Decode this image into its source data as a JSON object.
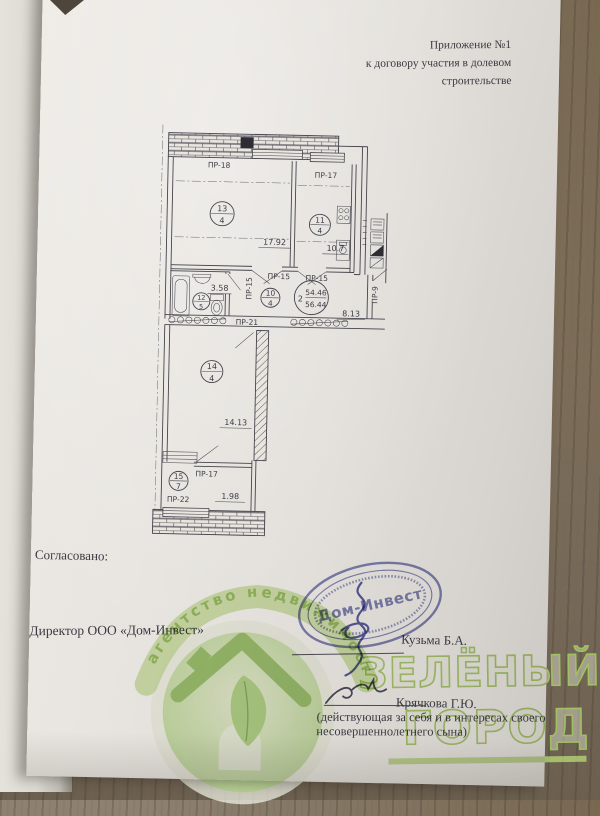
{
  "header": {
    "line1": "Приложение №1",
    "line2": "к договору участия в долевом строительстве"
  },
  "plan": {
    "window_labels": {
      "top_left": "ПР-18",
      "top_right": "ПР-17",
      "hall_left": "ПР-15",
      "hall_mid": "ПР-15",
      "hall_right": "ПР-15",
      "entry": "ПР-9",
      "partition": "ПР-21",
      "storage_door": "ПР-17",
      "storage_window": "ПР-22"
    },
    "rooms": {
      "living": {
        "num": "13",
        "type": "4",
        "area": "17.92"
      },
      "kitchen": {
        "num": "11",
        "type": "4",
        "area": "10.7"
      },
      "hall": {
        "num": "10",
        "type": "4"
      },
      "bath": {
        "num": "12",
        "type": "5",
        "area": "3.58"
      },
      "corridor": {
        "area": "8.13"
      },
      "room2": {
        "num": "14",
        "type": "4",
        "area": "14.13"
      },
      "storage": {
        "num": "15",
        "type": "7",
        "area": "1.98"
      }
    },
    "apartment": {
      "num": "2",
      "area_living": "54.46",
      "area_total": "56.44"
    }
  },
  "footer": {
    "agreed": "Согласовано:",
    "director": "Директор ООО «Дом-Инвест»",
    "director_name": "Кузьма Б.А.",
    "buyer_name": "Крячкова Г.Ю.",
    "buyer_note1": "(действующая за себя и в интересах своего",
    "buyer_note2": "несовершеннолетнего сына)"
  },
  "stamp": {
    "name": "Дом-Инвест"
  },
  "watermark": {
    "arc": "агентство недвижимости",
    "word1": "ЗЕЛЁНЫЙ",
    "word2": "ГОРОД"
  },
  "colors": {
    "stamp_ink": "#6e72b2",
    "wm_green": "#a6cd63",
    "plan_ink": "#45444c"
  }
}
